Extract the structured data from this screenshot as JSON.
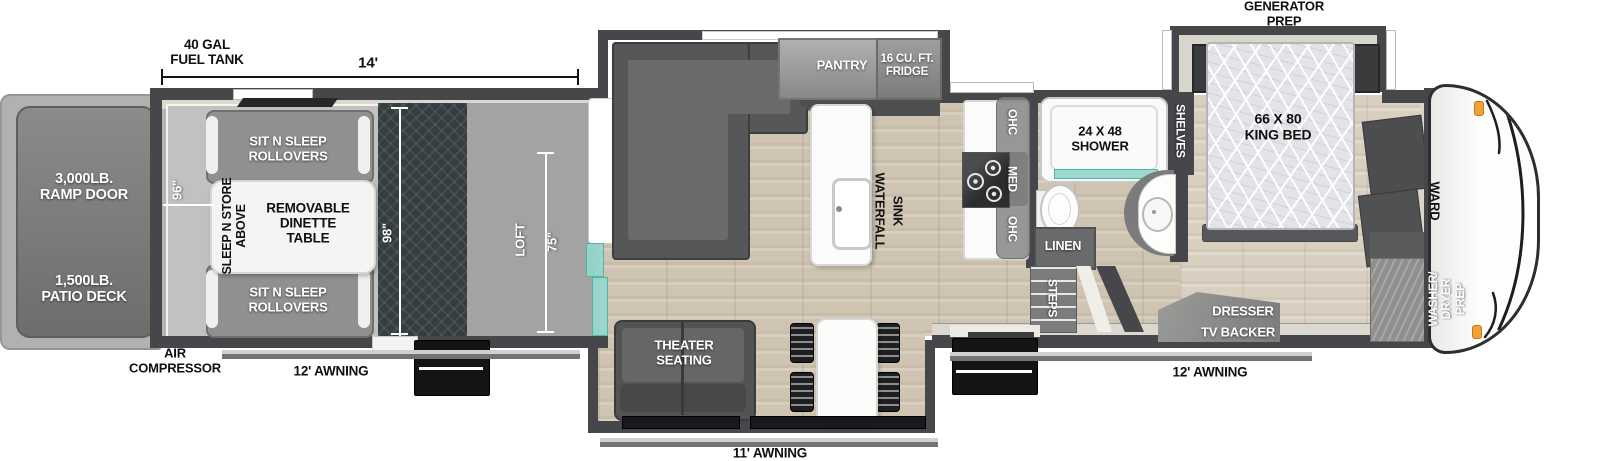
{
  "plan": {
    "exterior": {
      "ramp_door": "3,000LB.\nRAMP DOOR",
      "patio_deck": "1,500LB.\nPATIO DECK",
      "fuel_tank": "40 GAL\nFUEL TANK",
      "air_compressor": "AIR\nCOMPRESSOR",
      "generator_prep": "GENERATOR\nPREP",
      "awning_left": "12' AWNING",
      "awning_right": "12' AWNING",
      "awning_rear": "11' AWNING"
    },
    "dimensions": {
      "garage_length": "14'",
      "garage_slide_width": "96\"",
      "cargo_width": "98\"",
      "loft_length": "75\""
    },
    "garage": {
      "rollover_front": "SIT N SLEEP\nROLLOVERS",
      "rollover_rear": "SIT N SLEEP\nROLLOVERS",
      "dinette": "REMOVABLE\nDINETTE\nTABLE",
      "sleep_store": "SLEEP N STORE\nABOVE",
      "loft": "LOFT"
    },
    "kitchen": {
      "pantry": "PANTRY",
      "fridge": "16 CU. FT.\nFRIDGE",
      "sink_line1": "WATERFALL",
      "sink_line2": "SINK",
      "ohc_upper": "OHC",
      "med": "MED",
      "ohc_lower": "OHC"
    },
    "living": {
      "theater": "THEATER\nSEATING"
    },
    "bathroom": {
      "shower": "24 X 48\nSHOWER",
      "linen": "LINEN",
      "steps": "STEPS",
      "shelves": "SHELVES"
    },
    "bedroom": {
      "king_bed": "66 X 80\nKING BED",
      "wardrobe": "WARD",
      "dresser": "DRESSER",
      "tv_backer": "TV BACKER",
      "washer_dryer": "WASHER/\nDRYER\nPREP"
    },
    "colors": {
      "wall": "#46474a",
      "glass_teal": "#7fcec4",
      "marker_orange": "#f0a235"
    }
  }
}
